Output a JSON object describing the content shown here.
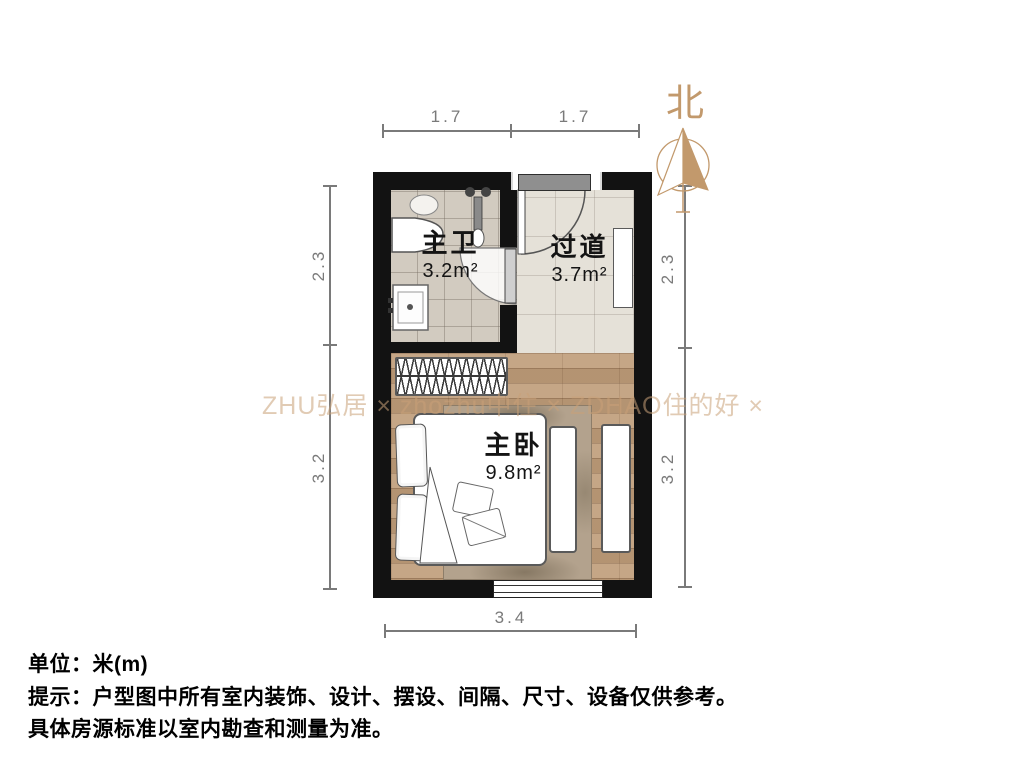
{
  "title": "户型图 (floor plan)",
  "compass": {
    "label": "北"
  },
  "rooms": [
    {
      "id": "bathroom",
      "name": "主卫",
      "area": "3.2m²"
    },
    {
      "id": "hallway",
      "name": "过道",
      "area": "3.7m²"
    },
    {
      "id": "bedroom",
      "name": "主卧",
      "area": "9.8m²"
    }
  ],
  "dimensions": {
    "unit": "米(m)",
    "top": [
      "1.7",
      "1.7"
    ],
    "left": [
      "2.3",
      "3.2"
    ],
    "right": [
      "2.3",
      "3.2"
    ],
    "bottom": [
      "3.4"
    ]
  },
  "watermark": "ZHU弘居 × zhozhu中住 × ZDHAO住的好 ×",
  "footer": {
    "line1": "单位：米(m)",
    "line2": "提示：户型图中所有室内装饰、设计、摆设、间隔、尺寸、设备仅供参考。",
    "line3": "具体房源标准以室内勘查和测量为准。"
  },
  "colors": {
    "wall": "#121212",
    "wood_floor": "#c19f7d",
    "tile_floor": "#d2cbc0",
    "accent_tan": "#c2996c",
    "dim_gray": "#7a7a7a"
  }
}
